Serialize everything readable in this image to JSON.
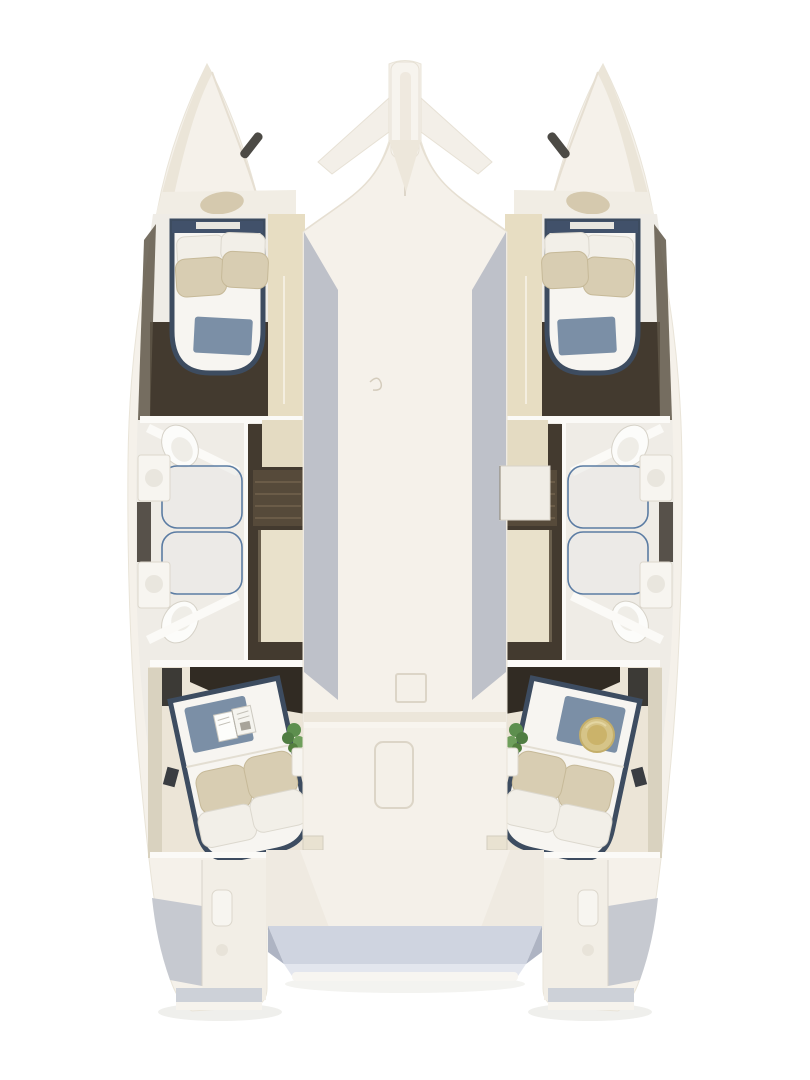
{
  "scene": {
    "type": "floor-plan",
    "subject": "catamaran-interior-top-view",
    "render": "3d-cutaway",
    "visible_text": "none"
  },
  "palette": {
    "background": "#ffffff",
    "hull": "#f5f1ea",
    "hull_edge": "#e9e4d8",
    "deck_shadow": "#b6bac4",
    "wood_floor": "#433a2f",
    "cabinet_tan": "#e7ddc2",
    "bed_frame": "#3d4c60",
    "linen": "#f2efe8",
    "pillow_beige": "#d8cdb2",
    "textile_blue": "#7b8fa6",
    "shower_glass": "#5b7ca3",
    "fixture_white": "#f7f5f0",
    "cockpit_floor": "#cfd4e0",
    "plant_green": "#5d8f4e",
    "straw_hat": "#d6c488"
  },
  "vessel": {
    "hulls": 2,
    "cabins": 4,
    "bathrooms": 4,
    "showers": 4,
    "port_hull": {
      "forward_cabin": [
        "double-bed",
        "white-pillows",
        "beige-pillows",
        "blue-throw",
        "wardrobe"
      ],
      "forward_bathroom": [
        "toilet",
        "vanity-sink",
        "shower"
      ],
      "aft_bathroom": [
        "toilet",
        "vanity-sink",
        "shower"
      ],
      "companionway": [
        "stairs",
        "wardrobe",
        "cabinet"
      ],
      "aft_cabin": [
        "double-bed",
        "pillows",
        "blue-throw",
        "open-book",
        "plant",
        "nightstand"
      ],
      "transom": [
        "swim-platform",
        "steps",
        "cleat"
      ]
    },
    "starboard_hull": {
      "forward_cabin": [
        "double-bed",
        "white-pillows",
        "beige-pillows",
        "blue-throw",
        "wardrobe"
      ],
      "forward_bathroom": [
        "toilet",
        "vanity-sink",
        "shower"
      ],
      "aft_bathroom": [
        "toilet",
        "vanity-sink",
        "shower"
      ],
      "companionway": [
        "stairs",
        "wardrobe",
        "cabinet",
        "stair-cover"
      ],
      "aft_cabin": [
        "double-bed",
        "pillows",
        "blue-throw",
        "straw-hat",
        "plant",
        "nightstand"
      ],
      "transom": [
        "swim-platform",
        "steps",
        "cleat"
      ]
    },
    "center": {
      "bow": [
        "bowsprit",
        "anchor-wings",
        "deck-window-slits"
      ],
      "coachroof": [
        "keel-line",
        "deck-emblem",
        "square-hatch",
        "long-hatch"
      ],
      "aft": [
        "cabin-entry-hatches",
        "cockpit",
        "bench",
        "stern-platform"
      ]
    }
  }
}
